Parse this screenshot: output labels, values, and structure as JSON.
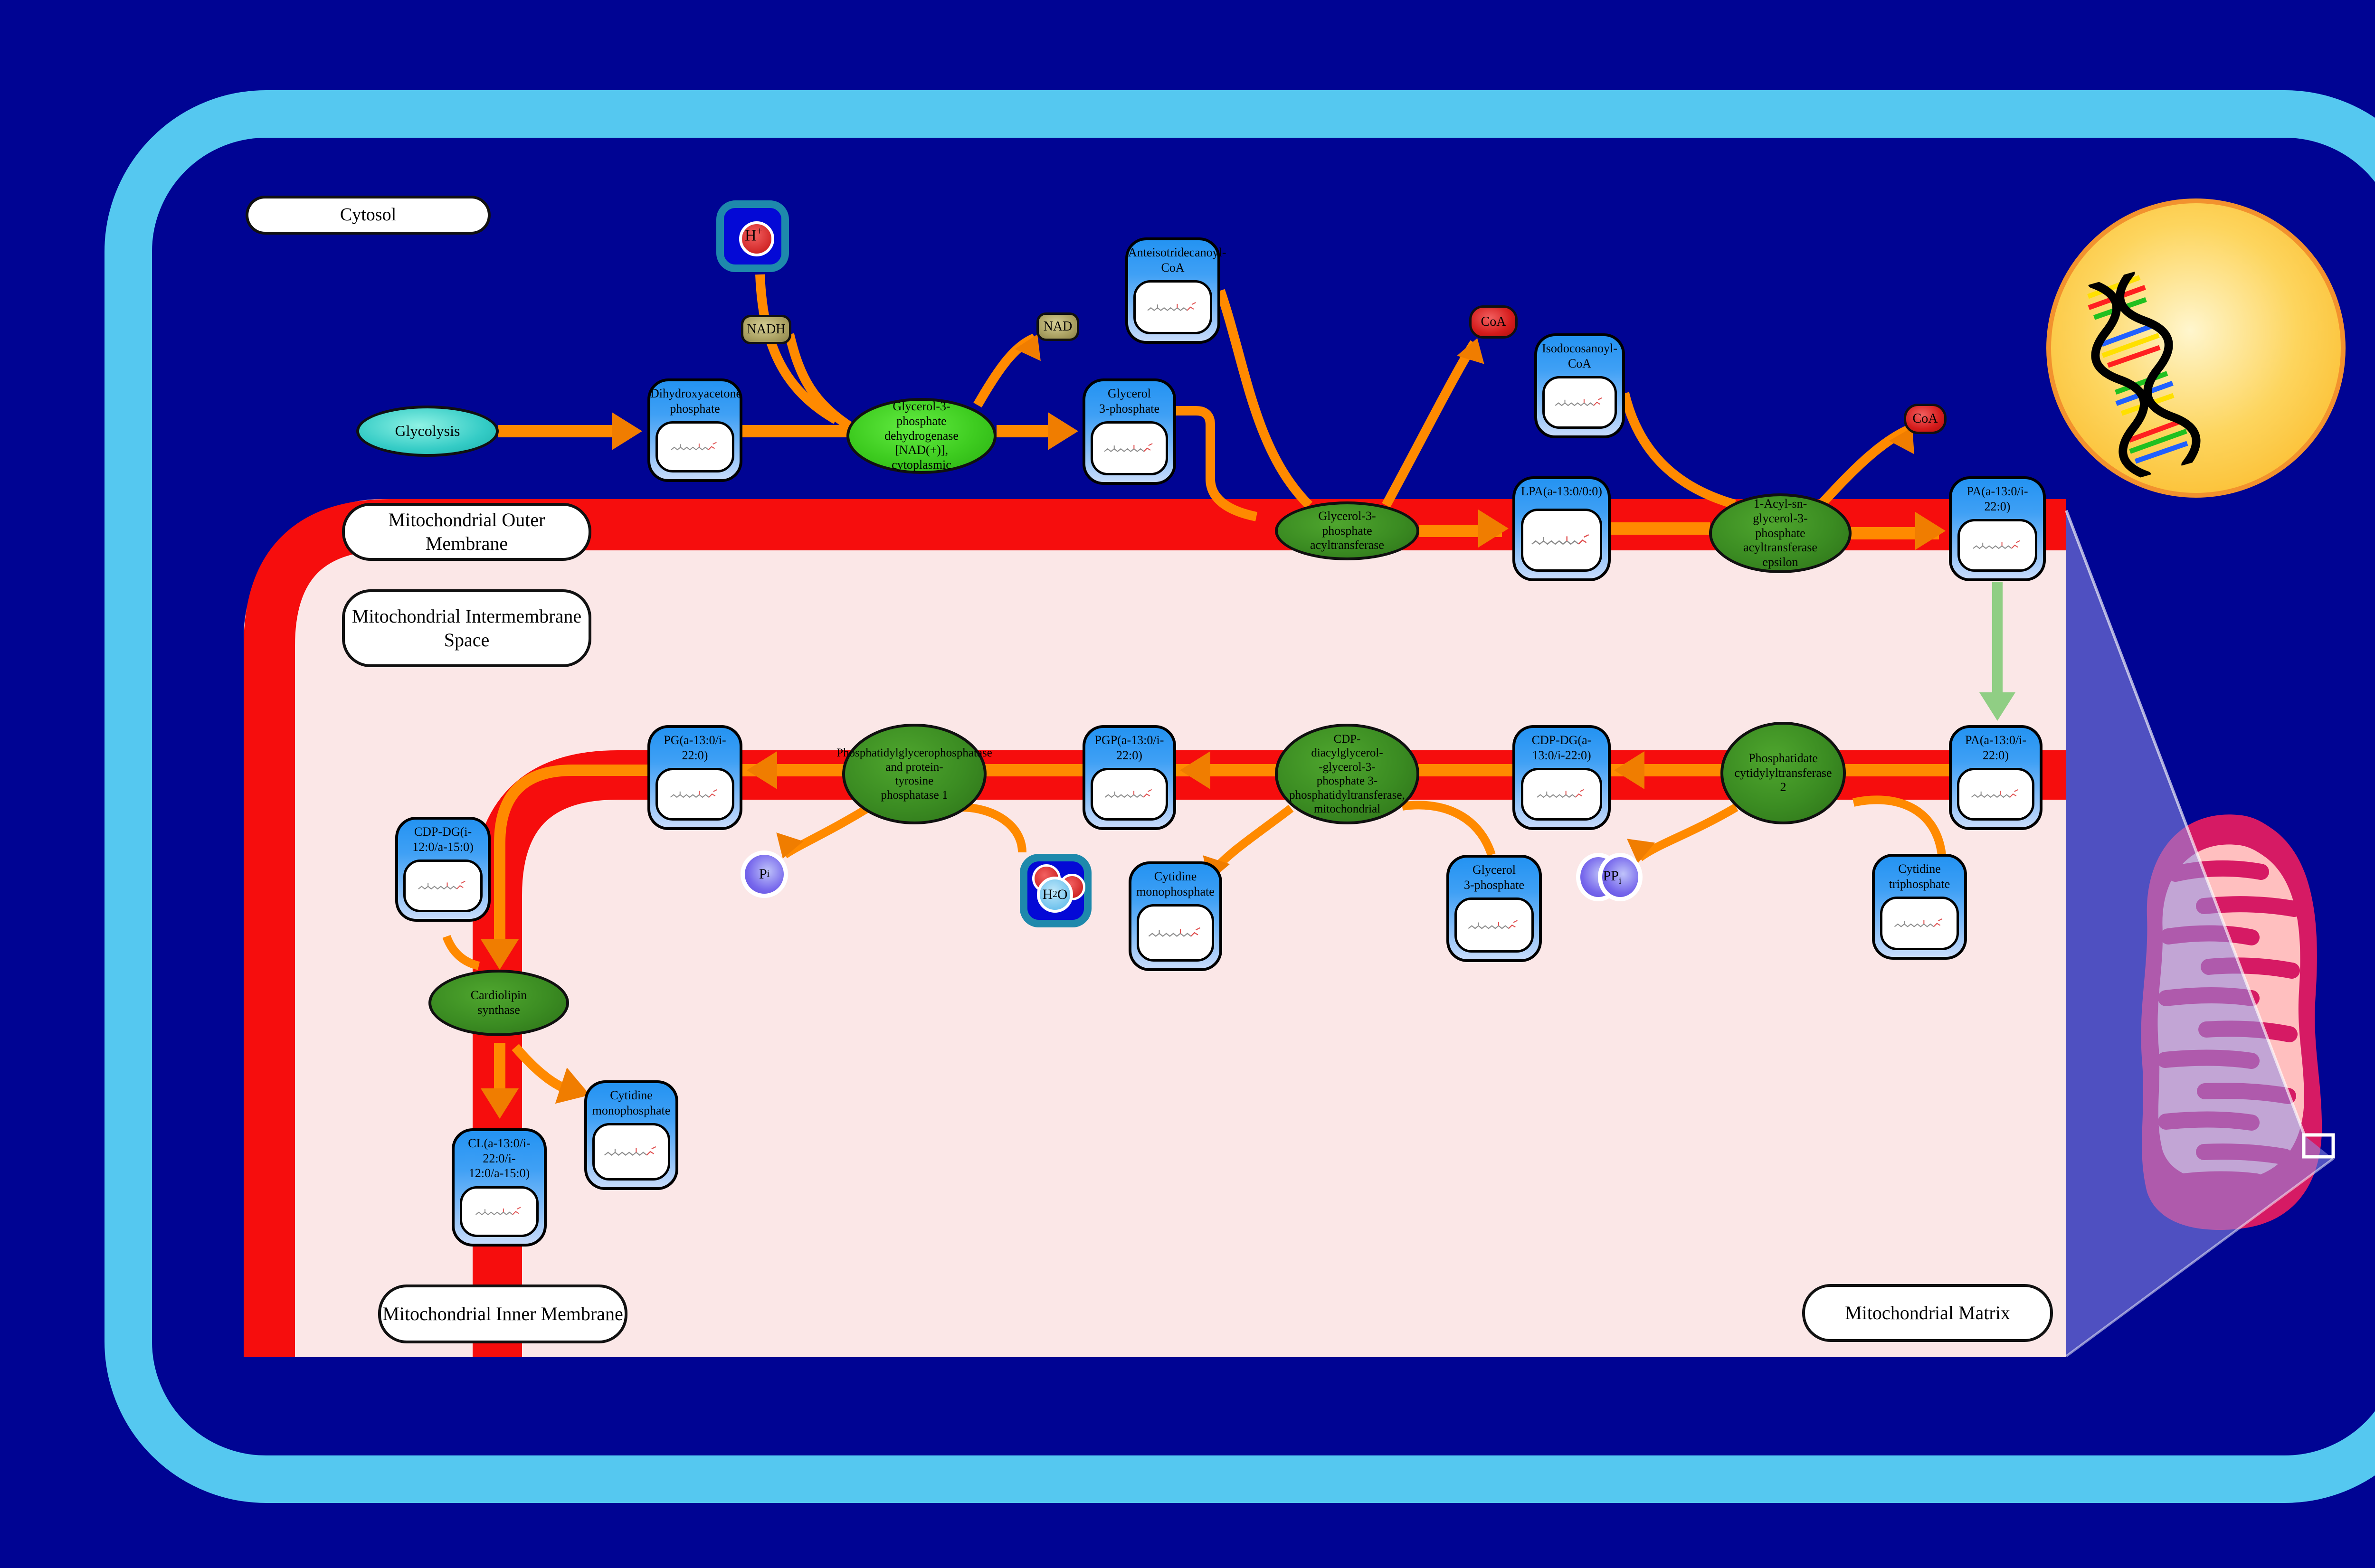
{
  "regions": {
    "cytosol": "Cytosol",
    "outer_membrane": "Mitochondrial Outer Membrane",
    "intermembrane_space": "Mitochondrial Intermembrane\nSpace",
    "inner_membrane": "Mitochondrial Inner Membrane",
    "matrix": "Mitochondrial Matrix"
  },
  "nodes": {
    "glycolysis": "Glycolysis",
    "dhap": "Dihydroxyacetone\nphosphate",
    "g3p": "Glycerol\n3-phosphate",
    "anteiso_coa": "Anteisotridecanoyl-\nCoA",
    "iso_coa": "Isodocosanoyl-\nCoA",
    "lpa": "LPA(a-13:0/0:0)",
    "pa": "PA(a-13:0/i-\n22:0)",
    "cdpdg": "CDP-DG(a-\n13:0/i-22:0)",
    "pgp": "PGP(a-13:0/i-\n22:0)",
    "pg": "PG(a-13:0/i-\n22:0)",
    "cdpdg2": "CDP-DG(i-\n12:0/a-15:0)",
    "cl": "CL(a-13:0/i-\n22:0/i-\n12:0/a-15:0)",
    "cmp": "Cytidine\nmonophosphate",
    "ctp": "Cytidine\ntriphosphate"
  },
  "enzymes": {
    "gpd": "Glycerol-3-\nphosphate\ndehydrogenase\n[NAD(+)],\ncytoplasmic",
    "gpat": "Glycerol-3-\nphosphate\nacyltransferase",
    "agpat": "1-Acyl-sn-\nglycerol-3-\nphosphate\nacyltransferase\nepsilon",
    "pct2": "Phosphatidate\ncytidylyltransferase\n2",
    "pgps": "CDP-\ndiacylglycerol-\n-glycerol-3-\nphosphate 3-\nphosphatidyltransferase,\nmitochondrial",
    "ptpmt1": "Phosphatidylglycerophosphatase\nand protein-\ntyrosine\nphosphatase 1",
    "cls": "Cardiolipin\nsynthase"
  },
  "icons": {
    "nadh": "NADH",
    "nad": "NAD",
    "coa": "CoA",
    "h_plus": {
      "main": "H",
      "sup": "+"
    },
    "h2o": {
      "pre": "H",
      "sub": "2",
      "post": "O"
    },
    "pi": {
      "main": "P",
      "sub": "i"
    },
    "ppi": {
      "main": "PP",
      "sub": "i"
    }
  },
  "colors": {
    "background": "#000493",
    "cell_border": "#55C8F0",
    "membrane_red": "#F60D0D",
    "matrix_pink": "#FBE7E7",
    "arrow_orange": "#FF8A00",
    "arrowhead_orange": "#F07D00",
    "green_arrow": "#90CE84",
    "enzyme_green": "#3B8C22",
    "metabolite_blue": "#2B97F3",
    "nucleus_yellow": "#FBB219",
    "mitochondrion_magenta": "#D61A64",
    "beam_purple": "#8C8CE6"
  }
}
